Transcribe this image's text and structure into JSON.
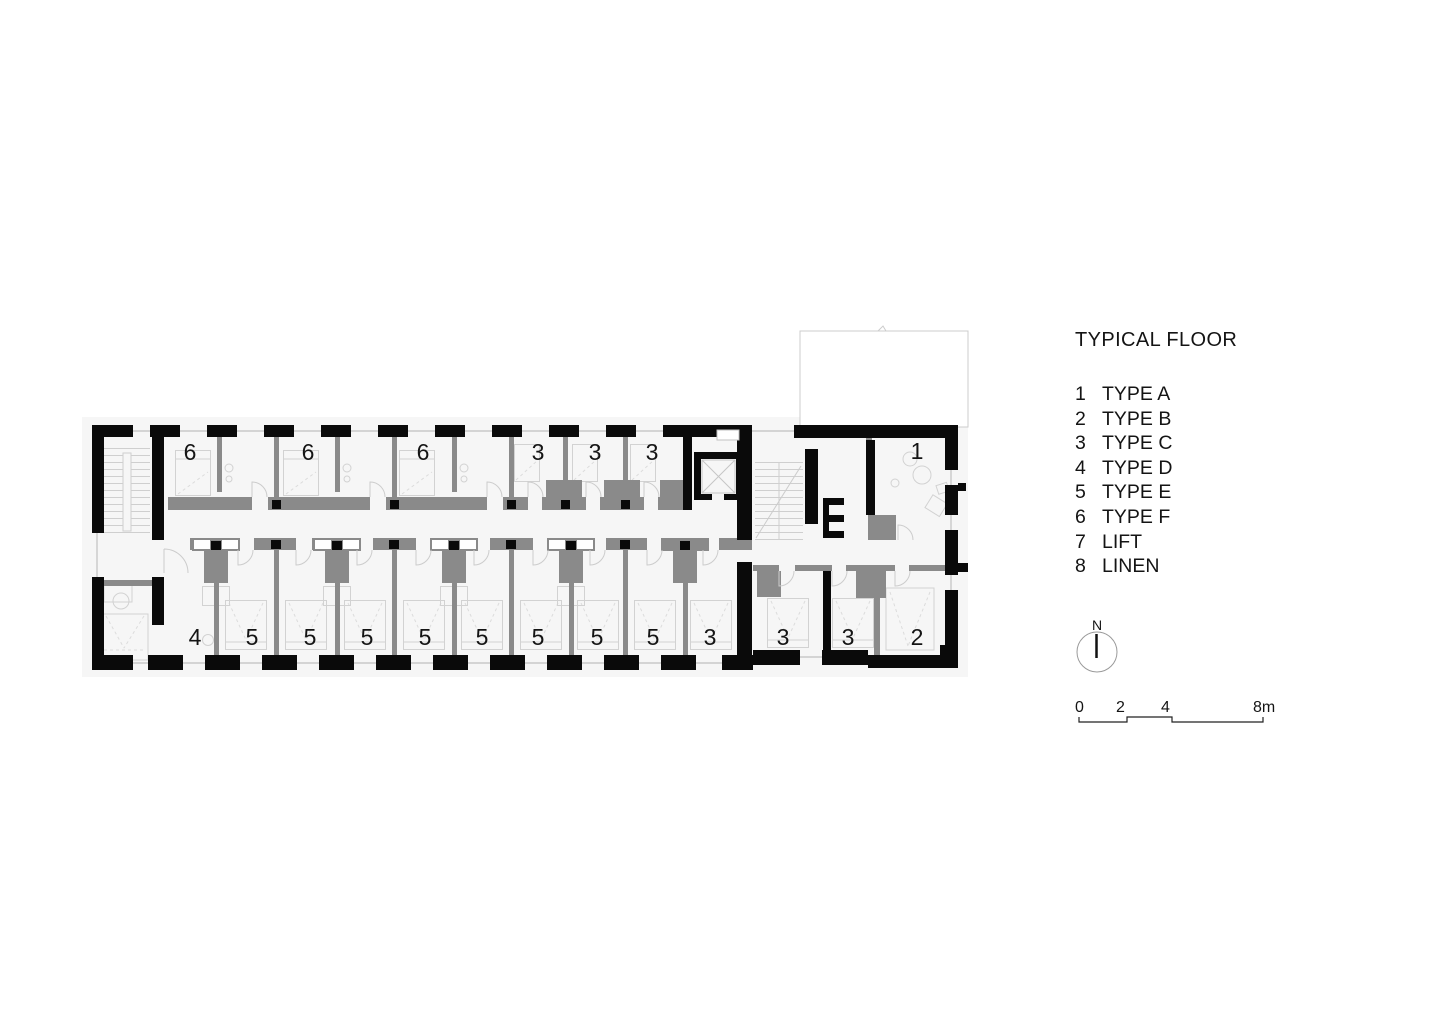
{
  "legend": {
    "title": "TYPICAL FLOOR",
    "items": [
      {
        "num": "1",
        "label": "TYPE A"
      },
      {
        "num": "2",
        "label": "TYPE B"
      },
      {
        "num": "3",
        "label": "TYPE C"
      },
      {
        "num": "4",
        "label": "TYPE D"
      },
      {
        "num": "5",
        "label": "TYPE E"
      },
      {
        "num": "6",
        "label": "TYPE F"
      },
      {
        "num": "7",
        "label": "LIFT"
      },
      {
        "num": "8",
        "label": "LINEN"
      }
    ]
  },
  "north_indicator": {
    "label": "N"
  },
  "scale_bar": {
    "labels": [
      "0",
      "2",
      "4",
      "8m"
    ]
  },
  "plan": {
    "colors": {
      "wall_black": "#0a0a0a",
      "wall_gray": "#8a8a8a",
      "panel_bg": "#f6f6f6",
      "furniture_line": "#d2d2d2"
    },
    "room_labels": [
      {
        "label": "6",
        "x": 190,
        "y": 460
      },
      {
        "label": "6",
        "x": 308,
        "y": 460
      },
      {
        "label": "6",
        "x": 423,
        "y": 460
      },
      {
        "label": "3",
        "x": 538,
        "y": 460
      },
      {
        "label": "3",
        "x": 595,
        "y": 460
      },
      {
        "label": "3",
        "x": 652,
        "y": 460
      },
      {
        "label": "1",
        "x": 917,
        "y": 459
      },
      {
        "label": "4",
        "x": 195,
        "y": 645
      },
      {
        "label": "5",
        "x": 252,
        "y": 645
      },
      {
        "label": "5",
        "x": 310,
        "y": 645
      },
      {
        "label": "5",
        "x": 367,
        "y": 645
      },
      {
        "label": "5",
        "x": 425,
        "y": 645
      },
      {
        "label": "5",
        "x": 482,
        "y": 645
      },
      {
        "label": "5",
        "x": 538,
        "y": 645
      },
      {
        "label": "5",
        "x": 597,
        "y": 645
      },
      {
        "label": "5",
        "x": 653,
        "y": 645
      },
      {
        "label": "3",
        "x": 710,
        "y": 645
      },
      {
        "label": "3",
        "x": 783,
        "y": 645
      },
      {
        "label": "3",
        "x": 848,
        "y": 645
      },
      {
        "label": "2",
        "x": 917,
        "y": 645
      }
    ]
  }
}
